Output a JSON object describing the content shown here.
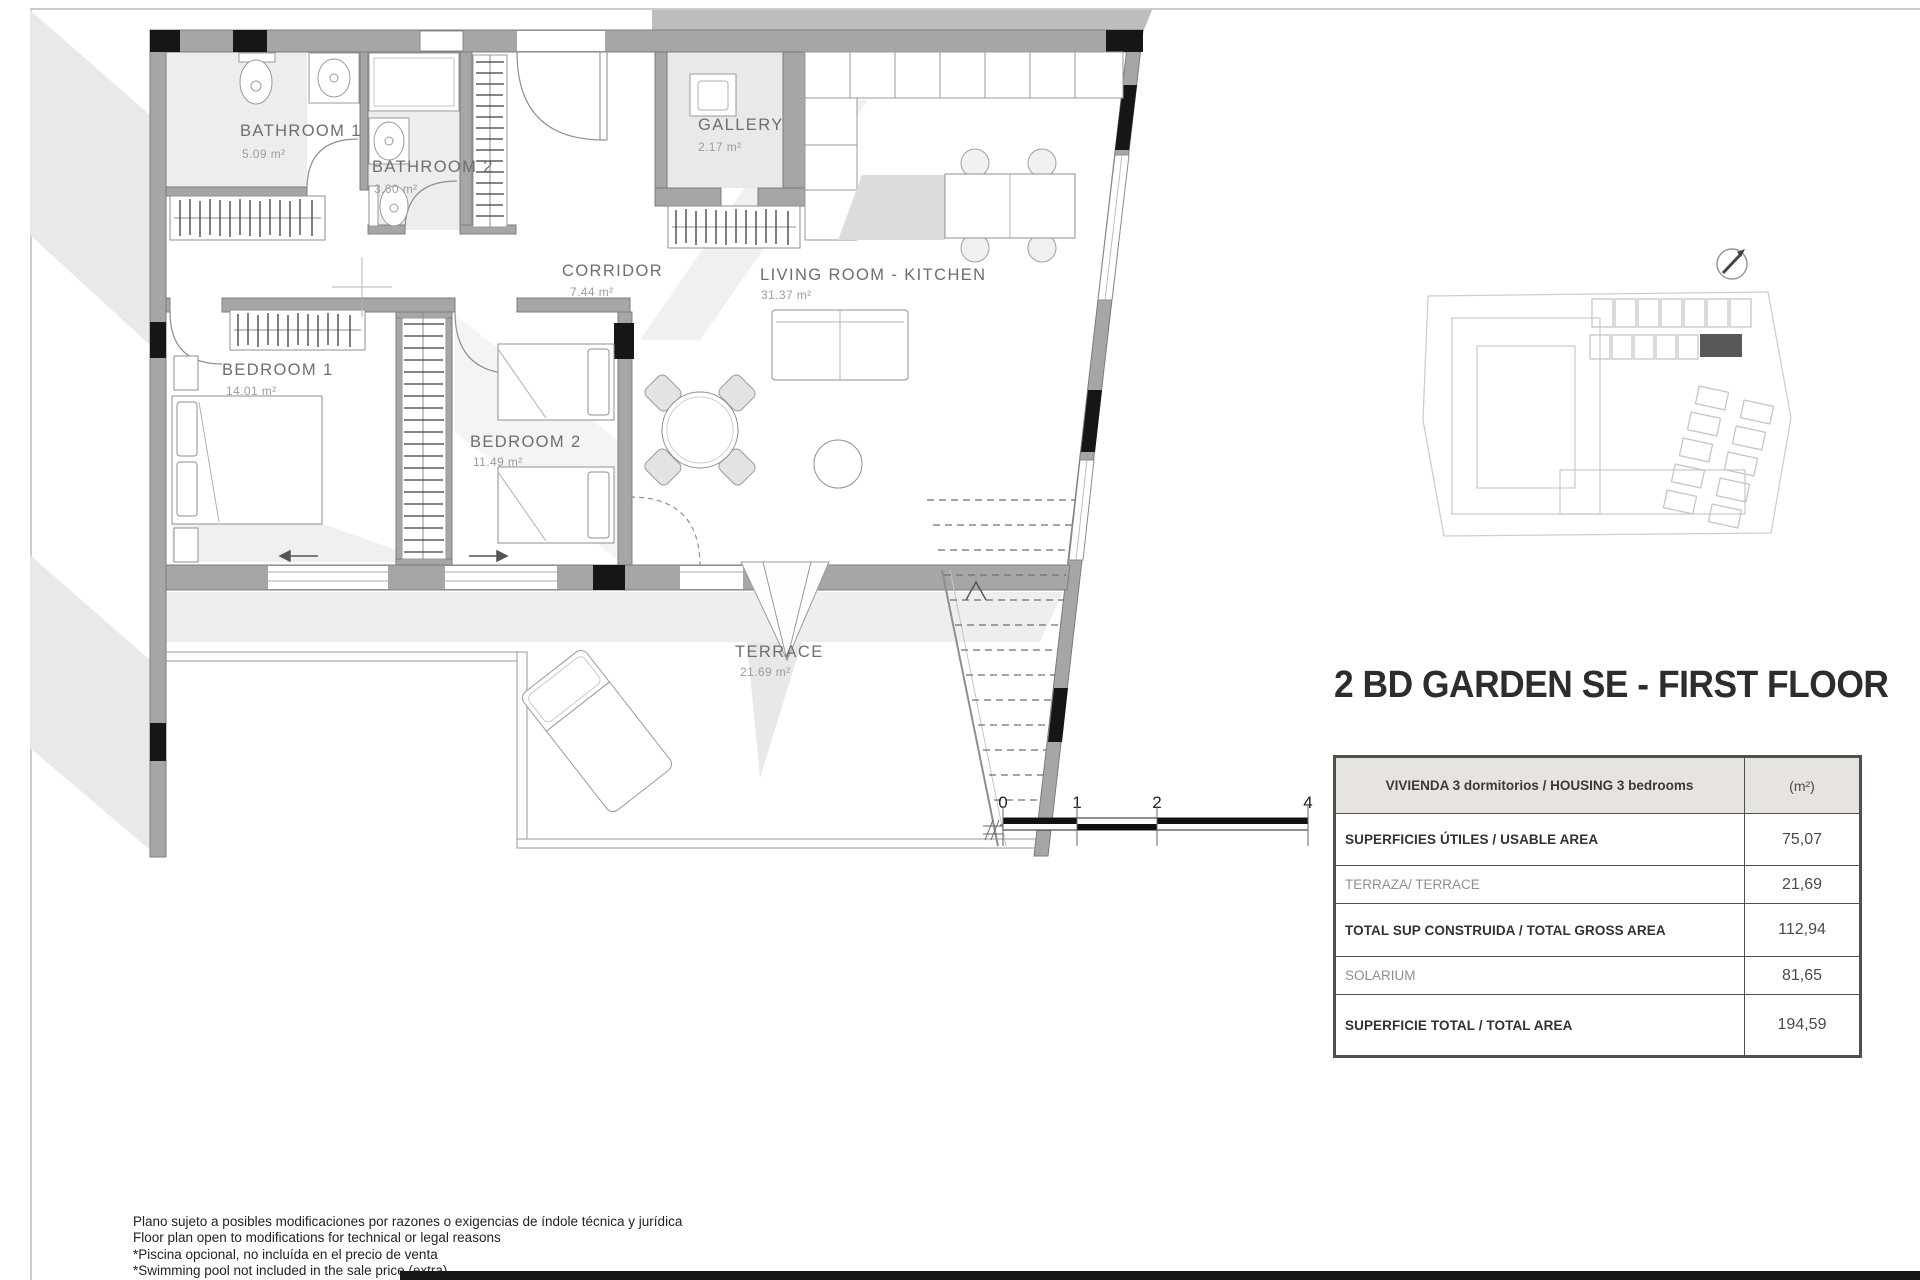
{
  "title": "2 BD GARDEN SE - FIRST FLOOR",
  "floor_plan": {
    "rooms": [
      {
        "name": "BATHROOM 1",
        "area": "5.09 m²"
      },
      {
        "name": "BATHROOM 2",
        "area": "3.60 m²"
      },
      {
        "name": "GALLERY",
        "area": "2.17 m²"
      },
      {
        "name": "CORRIDOR",
        "area": "7.44 m²"
      },
      {
        "name": "LIVING ROOM - KITCHEN",
        "area": "31.37 m²"
      },
      {
        "name": "BEDROOM 1",
        "area": "14.01 m²"
      },
      {
        "name": "BEDROOM 2",
        "area": "11.49 m²"
      },
      {
        "name": "TERRACE",
        "area": "21.69 m²"
      }
    ],
    "scale_bar": {
      "labels": [
        "0",
        "1",
        "2",
        "4"
      ]
    }
  },
  "area_table": {
    "header": {
      "label": "VIVIENDA 3 dormitorios / HOUSING 3 bedrooms",
      "unit": "(m²)"
    },
    "rows": [
      {
        "label": "SUPERFICIES ÚTILES / USABLE AREA",
        "value": "75,07"
      },
      {
        "label": "TERRAZA/ TERRACE",
        "value": "21,69"
      },
      {
        "label": "TOTAL SUP CONSTRUIDA / TOTAL GROSS AREA",
        "value": "112,94"
      },
      {
        "label": "SOLARIUM",
        "value": "81,65"
      },
      {
        "label": "SUPERFICIE TOTAL / TOTAL  AREA",
        "value": "194,59"
      }
    ]
  },
  "disclaimer": {
    "lines": [
      "Plano sujeto a posibles modificaciones por razones o exigencias de índole técnica y jurídica",
      "Floor plan open to modifications for technical or legal reasons",
      "*Piscina opcional, no incluída en el precio de venta",
      "*Swimming pool not included in the sale price (extra)"
    ]
  },
  "colors": {
    "wall": "#a6a6a6",
    "black_block": "#161616",
    "table_header_bg": "#e7e4e0",
    "highlighted_unit": "#575757"
  }
}
